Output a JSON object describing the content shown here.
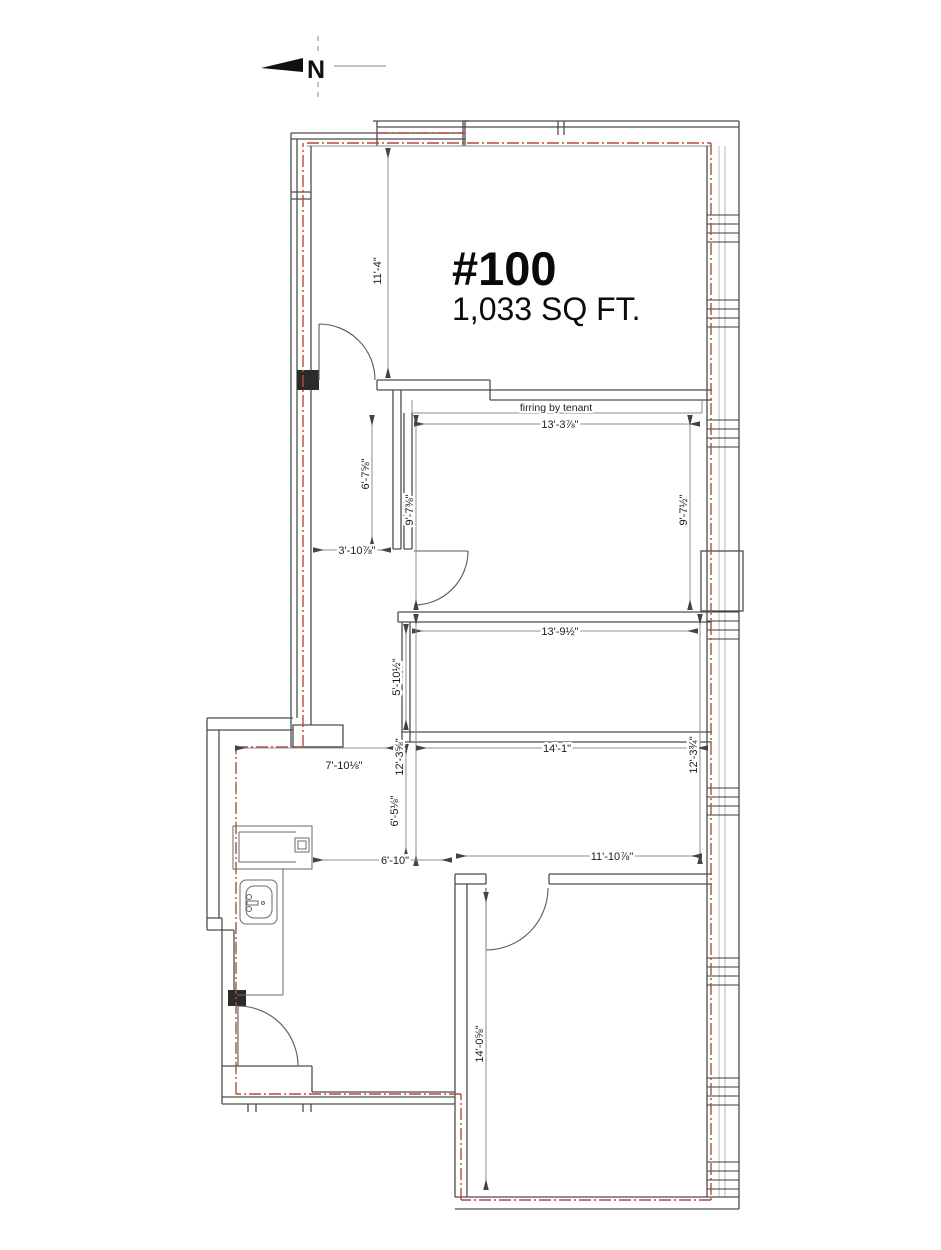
{
  "drawing": {
    "unit_number": "#100",
    "unit_area": "1,033 SQ FT.",
    "north_label": "N",
    "firring_note": "firring by tenant"
  },
  "dimensions": {
    "room1_height": "11'-4\"",
    "room2_width": "13'-3⅞\"",
    "corridor_wall_length": "6'-7⅝\"",
    "room2_height_left": "9'-7⅜\"",
    "room2_height_right": "9'-7½\"",
    "corridor_width": "3'-10⅞\"",
    "room3_width": "13'-9½\"",
    "room3_height": "5'-10½\"",
    "open_area_height_left": "12'-3⅝\"",
    "open_area_height_right": "12'-3¾\"",
    "lower_left_opening": "7'-10⅛\"",
    "open_area_width": "14'-1\"",
    "kitchen_height": "6'-5⅛\"",
    "kitchen_width": "6'-10\"",
    "bottom_room_width": "11'-10⅞\"",
    "bottom_room_height": "14'-0⅝\""
  },
  "icons": {
    "north_arrow": "left-pointing-triangle",
    "sink": "kitchen-sink-plan-symbol"
  },
  "colors": {
    "demising_line": "#b5493f",
    "wall_line": "#4d4d4d",
    "text": "#1c1c1c"
  }
}
